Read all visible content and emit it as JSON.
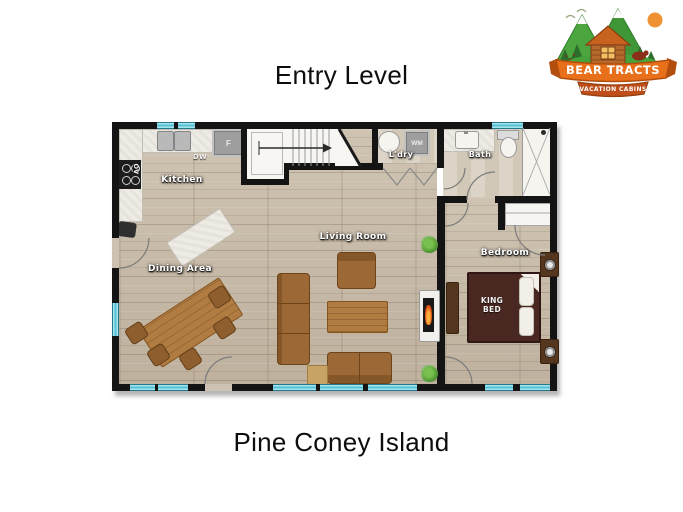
{
  "page": {
    "title": "Entry Level",
    "caption": "Pine Coney Island",
    "background": "#ffffff"
  },
  "logo": {
    "brand": "BEAR TRACTS",
    "tagline": "VACATION CABINS"
  },
  "floorplan": {
    "labels": {
      "kitchen": "Kitchen",
      "dining": "Dining Area",
      "living": "Living Room",
      "laundry": "L'dry",
      "bath": "Bath",
      "bedroom": "Bedroom"
    },
    "fixtures": {
      "dishwasher": "DW",
      "fridge": "F",
      "oven": "OV",
      "washer": "WM",
      "king_bed": "KING BED"
    },
    "colors": {
      "wall": "#141414",
      "window_glass": "#7bd2e0",
      "floor_wood": "#c9bcab",
      "floor_tile": "#d8cfc0",
      "sofa_wood": "#9c6836",
      "table_wood": "#b07c42",
      "bed": "#4a2822",
      "logo_orange": "#e8701a",
      "logo_green": "#46a33c"
    }
  }
}
